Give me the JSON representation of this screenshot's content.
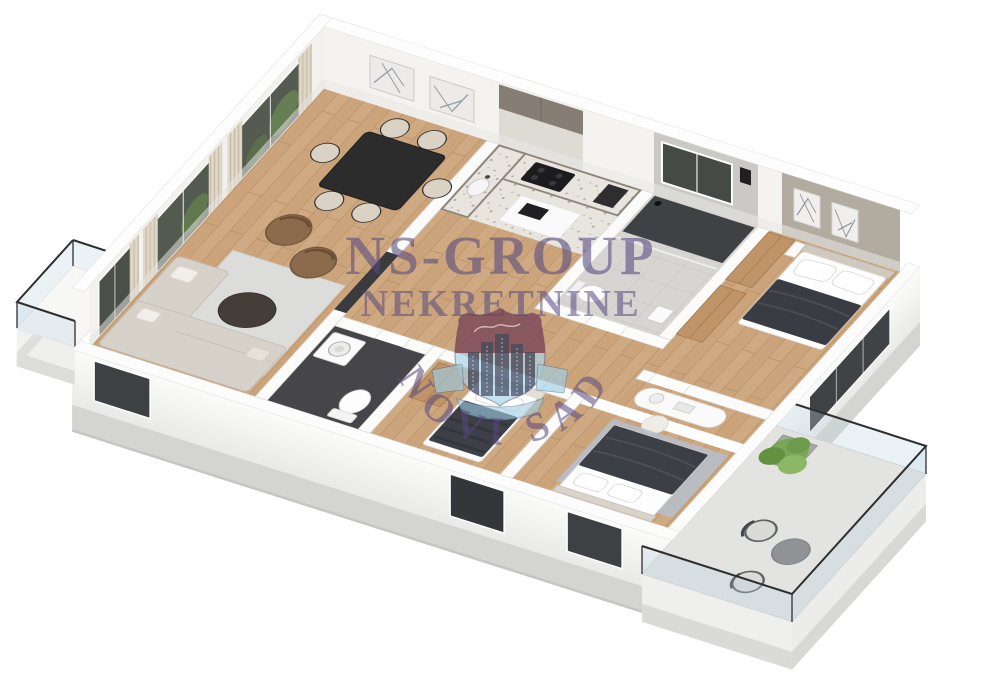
{
  "page": {
    "type": "real-estate-3d-floor-plan-render",
    "background_color": "#ffffff",
    "view": "isometric"
  },
  "watermark": {
    "agency_name": "NS-GROUP",
    "agency_subtitle": "NEKRETNINE",
    "city_arc_text": "NOVI SAD",
    "text_color": "#57497f",
    "logo": {
      "shape": "heraldic-shield",
      "crest_top_color": "#703246",
      "crest_bottom_color": "#a9d3e6",
      "emblem": "city-skyline-buildings",
      "ribbon_color": "#9fcfe4"
    }
  },
  "floor_plan": {
    "style": "3d-isometric-apartment",
    "rooms": [
      {
        "name": "living-dining-room",
        "floor": "wood"
      },
      {
        "name": "kitchen",
        "floor": "terrazzo"
      },
      {
        "name": "hallway",
        "floor": "wood"
      },
      {
        "name": "wc-laundry",
        "floor": "dark-tile"
      },
      {
        "name": "bathroom",
        "floor": "tile-with-shower"
      },
      {
        "name": "master-bedroom",
        "floor": "wood"
      },
      {
        "name": "bedroom-2",
        "floor": "wood"
      },
      {
        "name": "bedroom-3",
        "floor": "wood"
      },
      {
        "name": "balcony-left",
        "floor": "white"
      },
      {
        "name": "terrace-right",
        "floor": "concrete"
      }
    ],
    "furniture": [
      "corner-sofa",
      "area-rug",
      "coffee-table",
      "armchair-x2",
      "dining-table",
      "dining-chairs-x6",
      "kitchen-cabinets",
      "cooktop",
      "kitchen-island",
      "sink",
      "washing-machine",
      "toilet-x2",
      "shower",
      "double-bed-master",
      "wardrobe-x3",
      "wall-art-frames-x4",
      "vanity-desk",
      "stool",
      "single-bed",
      "double-bed-2",
      "bedroom-rug",
      "terrace-chairs-x2",
      "terrace-table",
      "potted-plant",
      "curtains",
      "glass-railing"
    ],
    "colors": {
      "wood_floor": "#cfa981",
      "walls": "#ffffff",
      "slab": "#d4d4d2",
      "accent_wall": "#b2aba0",
      "bathroom_floor": "#3f4245",
      "sofa": "#d6d1c9",
      "armchair": "#8b6b4b",
      "dining_table": "#2a2a2a",
      "bed_duvet": "#3a3d43",
      "bedroom_rug": "#b7c0cd",
      "plant": "#7aa757",
      "curtain": "#d9d0c0",
      "window_glass": "#53594f"
    }
  }
}
